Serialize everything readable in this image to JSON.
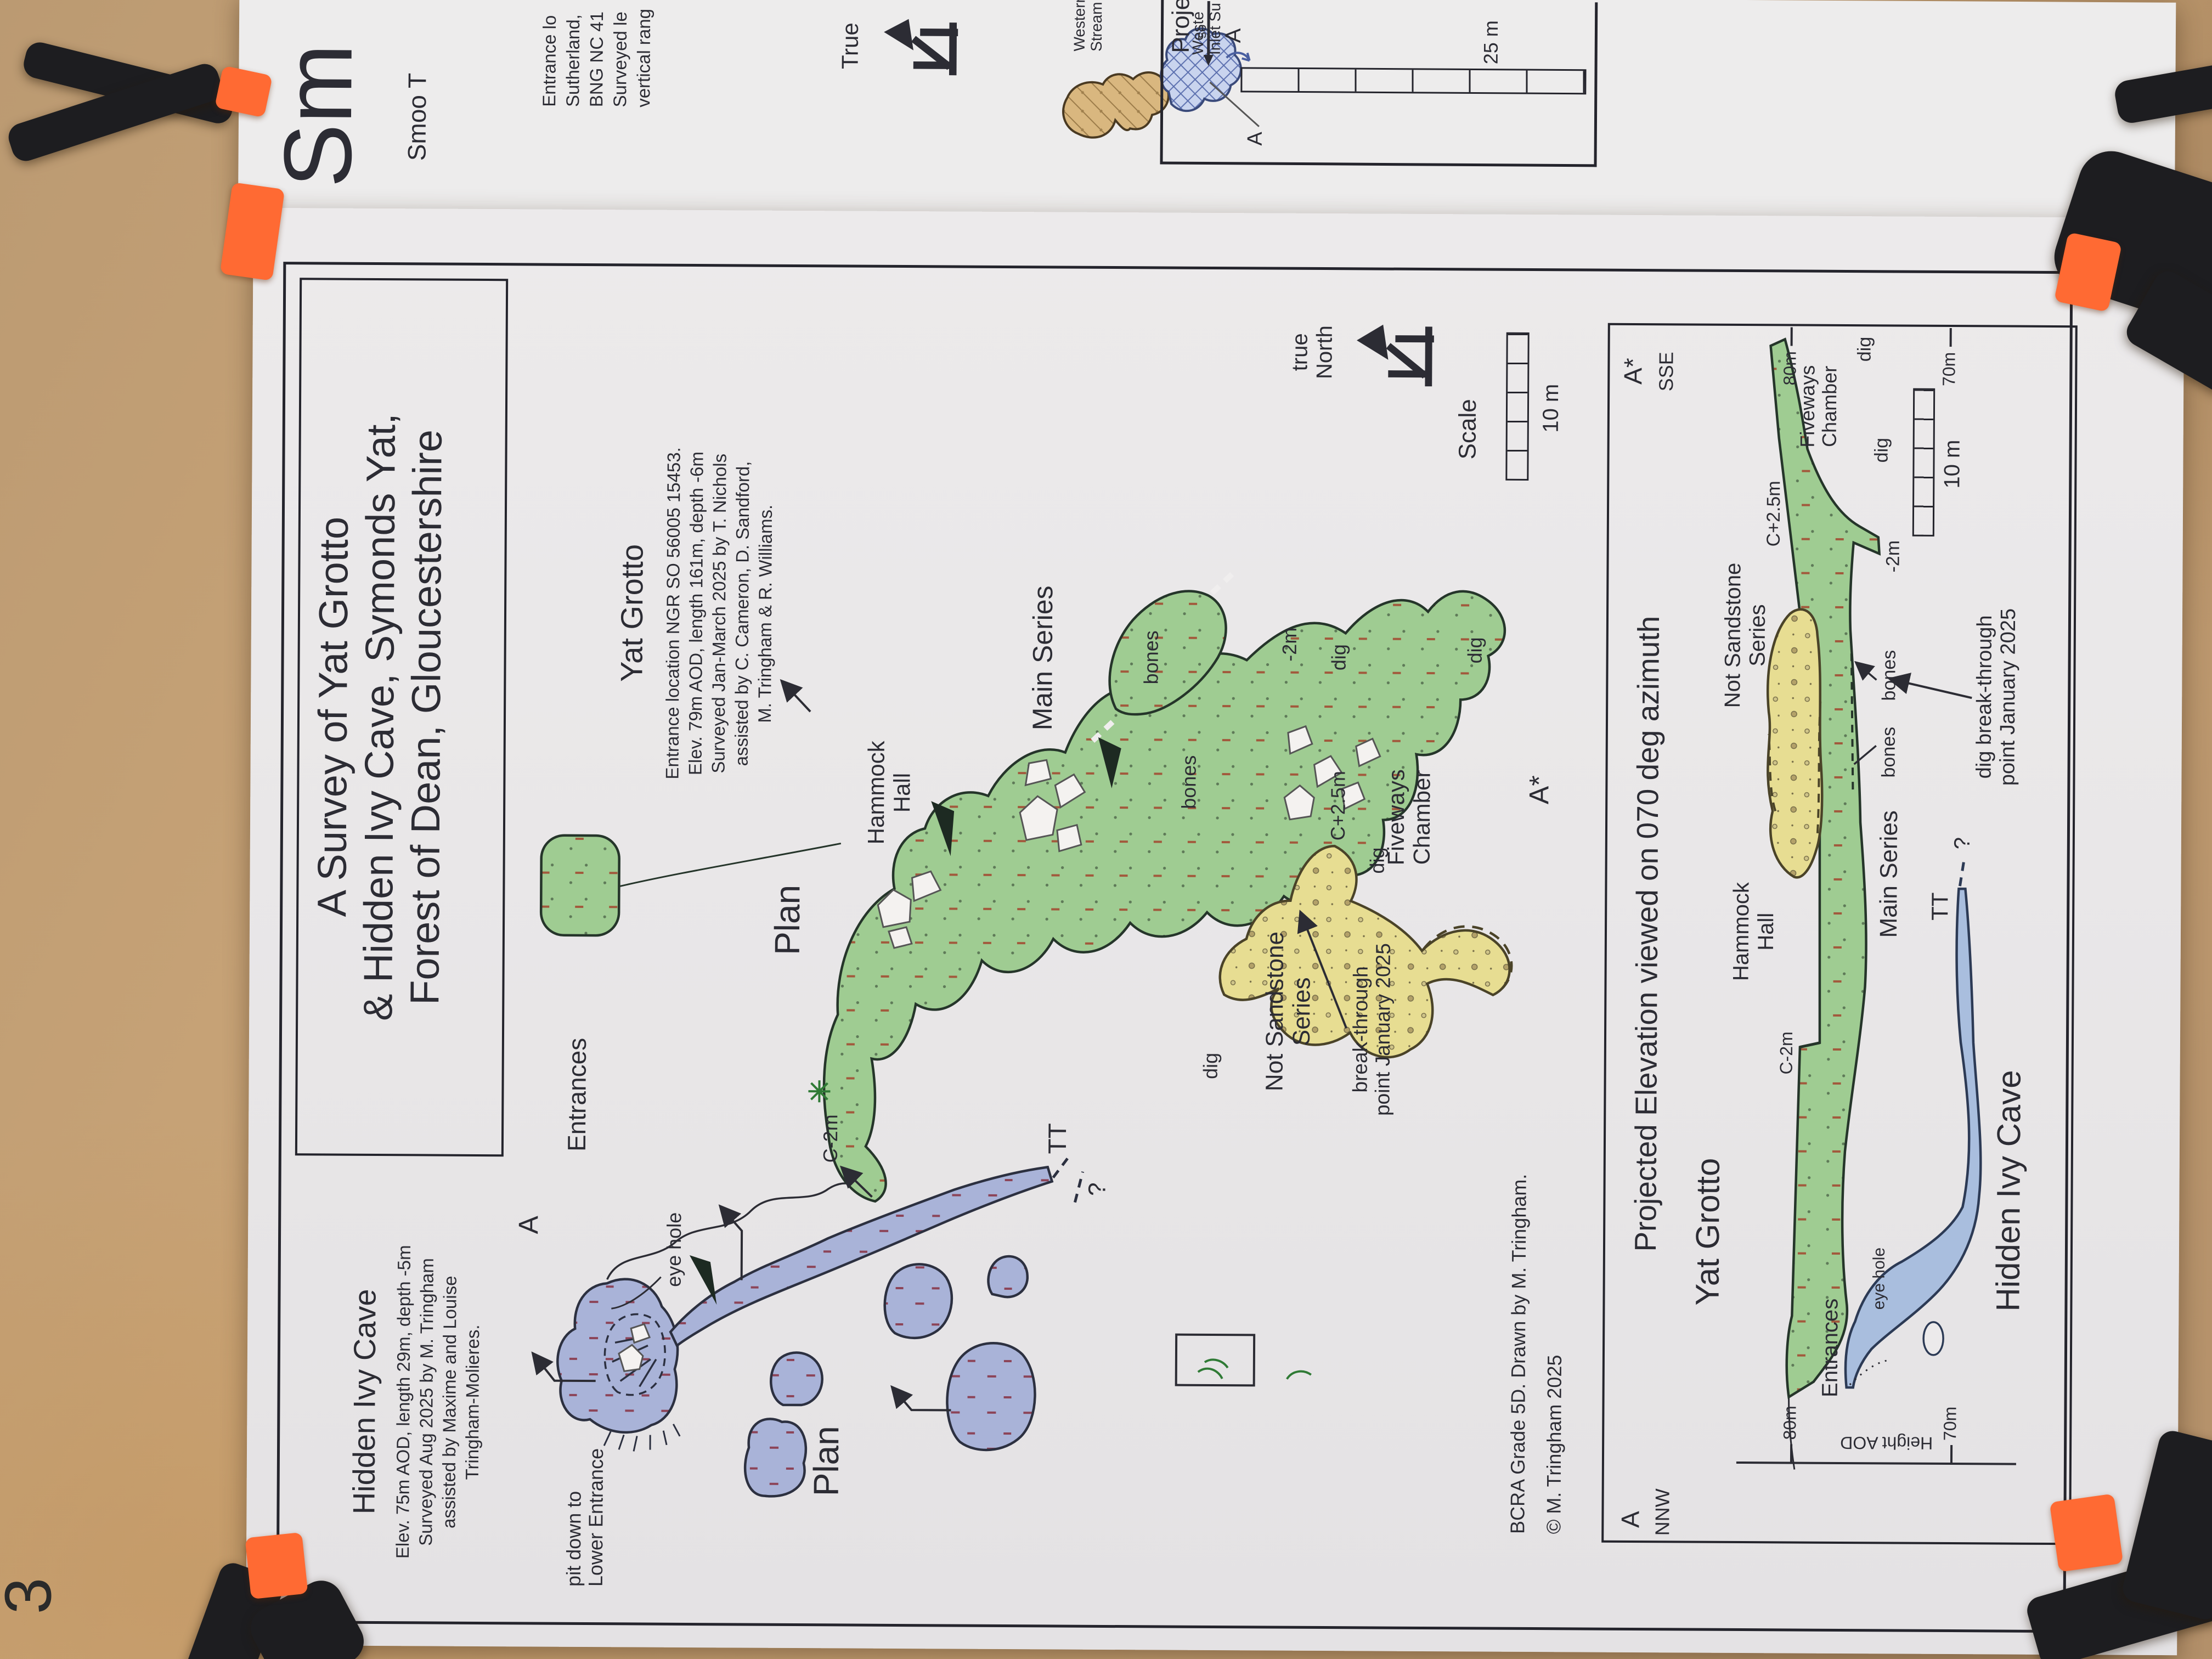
{
  "photo": {
    "page_number": "3"
  },
  "colors": {
    "board": "#c9a477",
    "paper": "#e9e7e8",
    "ink": "#2c2c34",
    "green_passage": "#9fcc92",
    "yellow_passage": "#e7dd92",
    "blue_plan": "#a9b3d8",
    "blue_elev": "#a9bede",
    "tan_map": "#d9b77f",
    "clamp_orange": "#ff6a33",
    "clamp_black": "#1d1d20",
    "red_tick": "#9c4040"
  },
  "back_page": {
    "title_fragment": "Sm",
    "subtitle_fragment": "Smoo T",
    "info_lines": [
      "Entrance lo",
      "Sutherland,",
      "BNG NC 41",
      "Surveyed le",
      "vertical rang"
    ],
    "true_north": {
      "label": "True"
    },
    "map_fragment": {
      "western_stream_1": "Western",
      "western_stream_2": "Stream",
      "western_inlet_1": "Weste",
      "western_inlet_2": "Inlet Su",
      "label_a": "A"
    },
    "inset": {
      "title_fragment": "Proje",
      "small_fragment": "so",
      "label_a": "A",
      "scale_label": "25 m"
    }
  },
  "survey": {
    "title_lines": [
      "A Survey of Yat Grotto",
      "& Hidden Ivy Cave, Symonds Yat,",
      "Forest of Dean, Gloucestershire"
    ],
    "hidden_ivy": {
      "heading": "Hidden Ivy Cave",
      "lines": [
        "Elev. 75m AOD, length 29m, depth -5m",
        "Surveyed Aug 2025 by M. Tringham",
        "assisted by  Maxime and Louise",
        "Tringham-Molieres."
      ]
    },
    "yat_grotto": {
      "heading": "Yat Grotto",
      "lines": [
        "Entrance location NGR SO 56005 15453.",
        "Elev. 79m AOD, length 161m, depth -6m",
        "Surveyed Jan-March 2025 by T. Nichols",
        "assisted by  C. Cameron, D. Sandford,",
        "M. Tringham & R. Williams."
      ]
    },
    "plan": {
      "plan_label_yat": "Plan",
      "plan_label_hidden_ivy": "Plan",
      "a": "A",
      "a_star": "A*",
      "entrances": "Entrances",
      "eye_hole": "eye hole",
      "pit_1": "pit down to",
      "pit_2": "Lower Entrance",
      "c_minus_2m": "C-2m",
      "tt": "TT",
      "question": "?",
      "hammock_1": "Hammock",
      "hammock_2": "Hall",
      "main_series": "Main Series",
      "bones_upper": "bones",
      "bones_lower": "bones",
      "minus_2m": "-2m",
      "dig_top": "dig",
      "dig_right": "dig",
      "dig_nss": "dig",
      "dig_fiveways": "dig",
      "not_sandstone_1": "Not Sandstone",
      "not_sandstone_2": "Series",
      "breakthrough_1": "break-through",
      "breakthrough_2": "point January 2025",
      "c_plus_25m": "C+2.5m",
      "fiveways_1": "Fiveways",
      "fiveways_2": "Chamber"
    },
    "north": {
      "line1": "true",
      "line2": "North"
    },
    "scale": {
      "label": "Scale",
      "value": "10 m"
    },
    "credits": {
      "line1": "BCRA Grade 5D. Drawn by M. Tringham.",
      "line2": "© M. Tringham 2025"
    },
    "elevation": {
      "title": "Projected Elevation viewed on 070 deg azimuth",
      "corner_left_a": "A",
      "corner_left_dir": "NNW",
      "corner_right_a": "A*",
      "corner_right_dir": "SSE",
      "axis_label": "Height AOD",
      "tick_80": "80m",
      "tick_70": "70m",
      "yat_grotto": "Yat Grotto",
      "hammock_1": "Hammock",
      "hammock_2": "Hall",
      "c_minus_2m": "C-2m",
      "eye_hole": "eye hole",
      "entrances": "Entrances",
      "main_series": "Main Series",
      "hidden_ivy": "Hidden Ivy Cave",
      "tt": "TT",
      "question": "?",
      "not_sandstone_1": "Not Sandstone",
      "not_sandstone_2": "Series",
      "c_plus_25m": "C+2.5m",
      "fiveways_1": "Fiveways",
      "fiveways_2": "Chamber",
      "minus_2m": "-2m",
      "dig_mid": "dig",
      "dig_tip": "dig",
      "bones_1": "bones",
      "bones_2": "bones",
      "breakthrough_1": "dig break-through",
      "breakthrough_2": "point January 2025",
      "scale_value": "10 m"
    }
  }
}
